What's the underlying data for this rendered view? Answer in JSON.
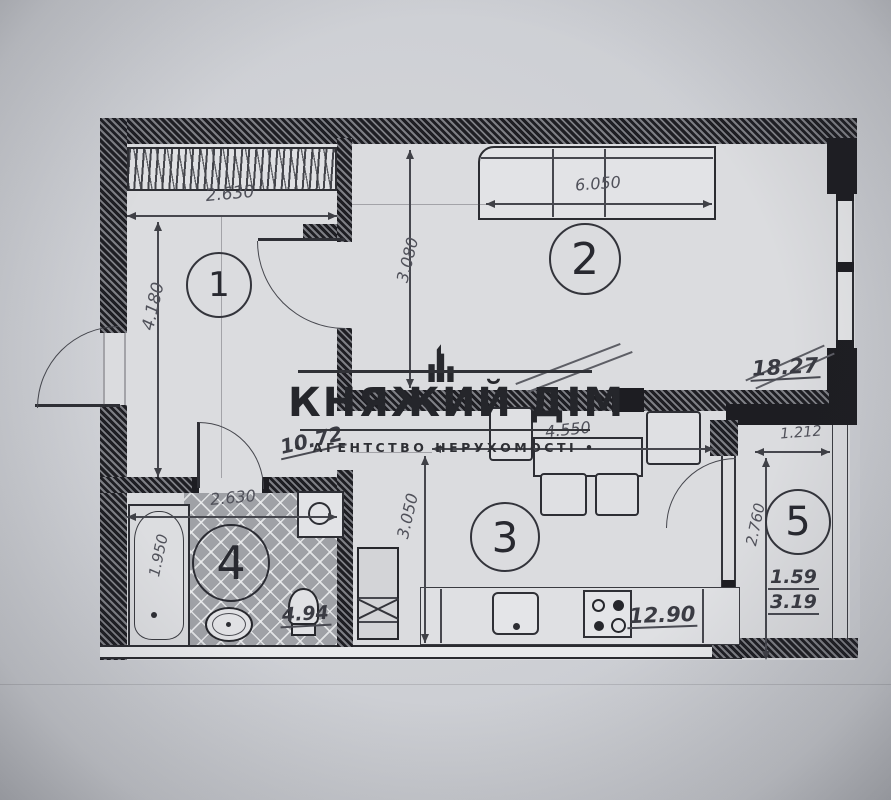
{
  "watermark": {
    "title": "КНЯЖИЙ ДІМ",
    "subtitle": "• АГЕНТСТВО НЕРУХОМОСТІ •"
  },
  "rooms": {
    "r1": {
      "number": "1",
      "area": "10.72",
      "dim_width": "2.630",
      "dim_height": "4.180"
    },
    "r2": {
      "number": "2",
      "area": "18.27",
      "dim_window": "6.050",
      "dim_height": "3.080"
    },
    "r3": {
      "number": "3",
      "area": "12.90",
      "dim_width": "4.550",
      "dim_height": "3.050"
    },
    "r4": {
      "number": "4",
      "area": "4.94",
      "dim_width": "2.630",
      "dim_tub": "1.950"
    },
    "r5": {
      "number": "5",
      "area_coeff": "1.59",
      "area": "3.19",
      "dim_width": "1.212",
      "dim_height": "2.760"
    }
  },
  "colors": {
    "paper": "#cdcfd4",
    "floor": "#dbdcdf",
    "wall": "#1d1d22",
    "tile": "#9fa1a6",
    "ink": "#46474e"
  }
}
